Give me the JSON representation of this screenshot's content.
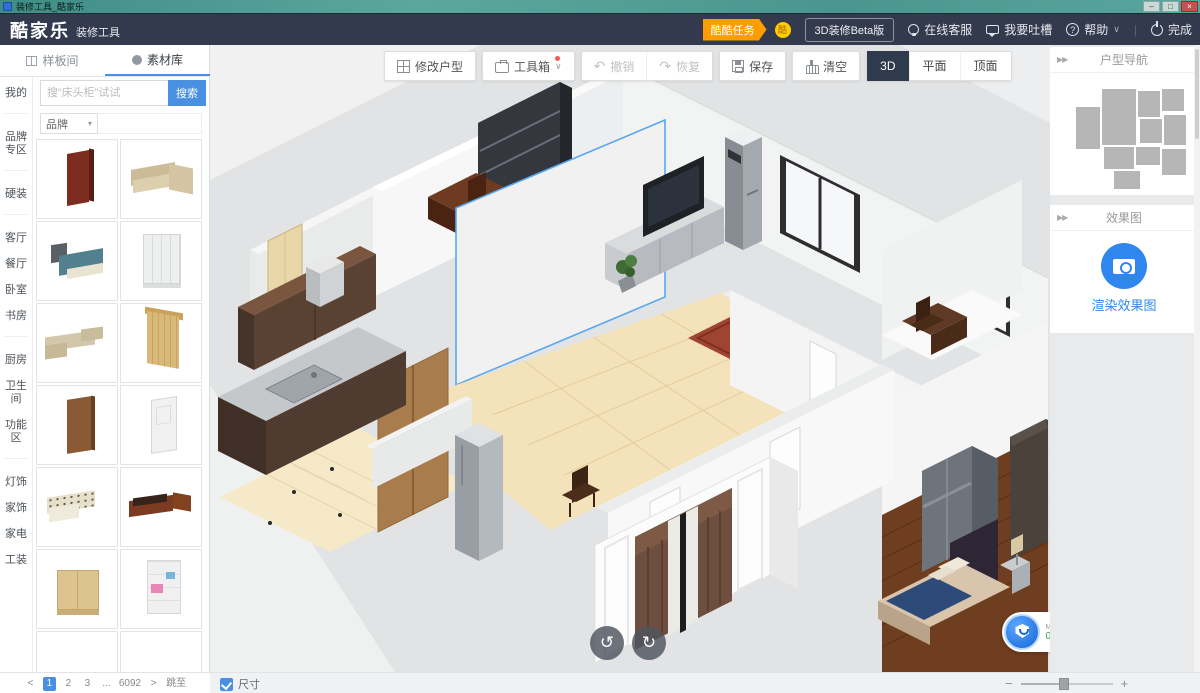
{
  "window": {
    "title": "装修工具_酷家乐",
    "controls": {
      "min": "–",
      "max": "□",
      "close": "×"
    }
  },
  "navbar": {
    "logo": "酷家乐",
    "logo_suffix": "装修工具",
    "task_badge": "酷酷任务",
    "coin": "酷",
    "beta_button": "3D装修Beta版",
    "service": "在线客服",
    "feedback": "我要吐槽",
    "help": "帮助",
    "help_chevron": "∨",
    "divider": "|",
    "finish": "完成"
  },
  "sidebar": {
    "tabs": [
      {
        "label": "样板间",
        "active": false
      },
      {
        "label": "素材库",
        "active": true
      }
    ],
    "search": {
      "placeholder": "搜“床头柜”试试",
      "button": "搜索"
    },
    "brand_filter": "品牌",
    "brand_arrow": "▾",
    "categories": [
      "我的",
      "品牌专区",
      "硬装",
      "客厅",
      "餐厅",
      "卧室",
      "书房",
      "厨房",
      "卫生间",
      "功能区",
      "灯饰",
      "家饰",
      "家电",
      "工装"
    ],
    "items": [
      "red-panel-door",
      "beige-corner-sofa",
      "blue-double-bed",
      "white-four-door-wardrobe",
      "beige-sectional-sofa",
      "gold-curtain",
      "brown-wood-door",
      "white-wood-door",
      "floral-fabric-sofa",
      "redwood-sofa-set",
      "light-wood-cabinet",
      "white-desk-bookshelf",
      "blue-floral-sofa",
      "white-corner-sofa"
    ],
    "pagination": {
      "prev": "<",
      "pages": [
        "1",
        "2",
        "3"
      ],
      "ellipsis": "...",
      "last": "6092",
      "next": ">",
      "jump": "跳至"
    }
  },
  "toolbar": {
    "modify_layout": "修改户型",
    "toolbox": "工具箱",
    "toolbox_chevron": "∨",
    "undo": "撤销",
    "undo_icon": "↶",
    "redo": "恢复",
    "redo_icon": "↷",
    "save": "保存",
    "clear": "清空",
    "view_modes": [
      {
        "label": "3D",
        "active": true
      },
      {
        "label": "平面",
        "active": false
      },
      {
        "label": "顶面",
        "active": false
      }
    ]
  },
  "canvas": {
    "rotate_left_icon": "↺",
    "rotate_right_icon": "↻",
    "security_badge": {
      "line1": "MESSA",
      "value": "0",
      "unit": "/mi"
    }
  },
  "right_panel": {
    "collapse_icon": "▶▶",
    "floorplan_nav_title": "户型导航",
    "render_section_title": "效果图",
    "render_button": "渲染效果图"
  },
  "bottom_bar": {
    "dimension_label": "尺寸",
    "zoom_minus": "−",
    "zoom_plus": "+"
  },
  "colors": {
    "accent_blue": "#4a90e2",
    "navbar_bg": "#333a4d",
    "badge_orange": "#ff9d00",
    "render_blue": "#2f87ee",
    "selection_blue": "#5aa7f0",
    "titlebar_teal": "#4a968e"
  }
}
